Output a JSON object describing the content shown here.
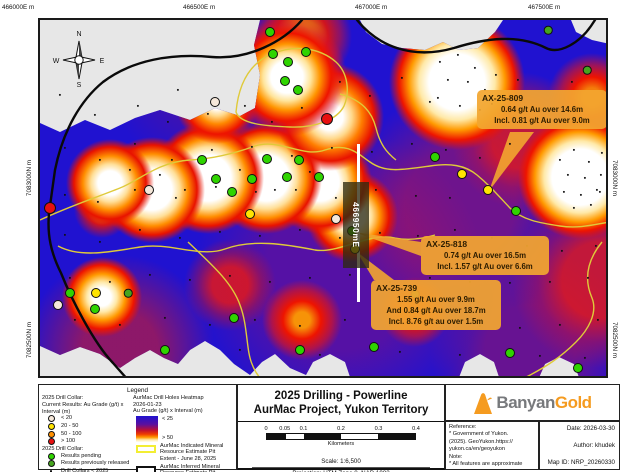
{
  "map": {
    "easting_labels": [
      "466000E m",
      "466500E m",
      "467000E m",
      "467500E m"
    ],
    "northing_labels": [
      "7083000N m",
      "7082500N m"
    ],
    "compass": {
      "north": "N",
      "east": "E",
      "south": "S",
      "west": "W"
    },
    "section_line_label": "466950mE",
    "annotations": [
      {
        "hole_id": "AX-25-809",
        "lines": [
          "0.64 g/t Au over 14.6m",
          "Incl. 0.81 g/t Au over 9.0m"
        ]
      },
      {
        "hole_id": "AX-25-818",
        "lines": [
          "0.74 g/t Au over 16.5m",
          "Incl. 1.57 g/t Au over 6.6m"
        ]
      },
      {
        "hole_id": "AX-25-739",
        "lines": [
          "1.55 g/t Au over 9.9m",
          "And 0.84 g/t Au over 18.7m",
          "Incl. 8.76 g/t au over 1.5m"
        ]
      }
    ],
    "markers": {
      "black": [
        [
          20,
          75
        ],
        [
          55,
          95
        ],
        [
          98,
          86
        ],
        [
          138,
          70
        ],
        [
          128,
          102
        ],
        [
          168,
          94
        ],
        [
          205,
          86
        ],
        [
          232,
          102
        ],
        [
          262,
          88
        ],
        [
          300,
          62
        ],
        [
          330,
          76
        ],
        [
          362,
          58
        ],
        [
          390,
          82
        ],
        [
          452,
          84
        ],
        [
          478,
          60
        ],
        [
          505,
          88
        ],
        [
          532,
          62
        ],
        [
          25,
          128
        ],
        [
          60,
          140
        ],
        [
          95,
          124
        ],
        [
          132,
          140
        ],
        [
          172,
          130
        ],
        [
          212,
          127
        ],
        [
          252,
          136
        ],
        [
          292,
          128
        ],
        [
          332,
          132
        ],
        [
          372,
          124
        ],
        [
          406,
          130
        ],
        [
          440,
          138
        ],
        [
          470,
          124
        ],
        [
          25,
          175
        ],
        [
          58,
          182
        ],
        [
          95,
          170
        ],
        [
          136,
          178
        ],
        [
          176,
          167
        ],
        [
          216,
          172
        ],
        [
          256,
          170
        ],
        [
          296,
          178
        ],
        [
          336,
          170
        ],
        [
          376,
          176
        ],
        [
          410,
          178
        ],
        [
          446,
          172
        ],
        [
          560,
          172
        ],
        [
          25,
          215
        ],
        [
          60,
          222
        ],
        [
          100,
          210
        ],
        [
          140,
          218
        ],
        [
          180,
          212
        ],
        [
          220,
          216
        ],
        [
          260,
          210
        ],
        [
          300,
          218
        ],
        [
          340,
          213
        ],
        [
          378,
          216
        ],
        [
          415,
          210
        ],
        [
          452,
          218
        ],
        [
          487,
          226
        ],
        [
          522,
          231
        ],
        [
          556,
          226
        ],
        [
          30,
          258
        ],
        [
          70,
          262
        ],
        [
          110,
          255
        ],
        [
          150,
          260
        ],
        [
          190,
          256
        ],
        [
          230,
          262
        ],
        [
          270,
          258
        ],
        [
          310,
          255
        ],
        [
          350,
          262
        ],
        [
          390,
          258
        ],
        [
          430,
          262
        ],
        [
          470,
          263
        ],
        [
          510,
          262
        ],
        [
          548,
          258
        ],
        [
          35,
          300
        ],
        [
          80,
          305
        ],
        [
          125,
          298
        ],
        [
          170,
          305
        ],
        [
          215,
          300
        ],
        [
          260,
          306
        ],
        [
          305,
          300
        ],
        [
          350,
          305
        ],
        [
          395,
          302
        ],
        [
          440,
          306
        ],
        [
          480,
          308
        ],
        [
          520,
          305
        ],
        [
          558,
          300
        ],
        [
          200,
          330
        ],
        [
          280,
          335
        ],
        [
          360,
          332
        ],
        [
          420,
          335
        ],
        [
          500,
          336
        ],
        [
          545,
          338
        ],
        [
          520,
          140
        ],
        [
          534,
          130
        ],
        [
          549,
          142
        ],
        [
          562,
          133
        ],
        [
          528,
          155
        ],
        [
          545,
          158
        ],
        [
          561,
          155
        ],
        [
          524,
          172
        ],
        [
          541,
          175
        ],
        [
          557,
          170
        ],
        [
          534,
          188
        ],
        [
          551,
          185
        ],
        [
          400,
          42
        ],
        [
          418,
          35
        ],
        [
          435,
          48
        ],
        [
          408,
          60
        ],
        [
          428,
          62
        ],
        [
          445,
          70
        ],
        [
          398,
          78
        ],
        [
          420,
          86
        ],
        [
          440,
          90
        ],
        [
          456,
          55
        ],
        [
          120,
          155
        ],
        [
          145,
          170
        ],
        [
          200,
          150
        ],
        [
          235,
          170
        ],
        [
          270,
          152
        ],
        [
          90,
          150
        ]
      ],
      "pending": [
        [
          230,
          12
        ],
        [
          233,
          34
        ],
        [
          248,
          42
        ],
        [
          245,
          61
        ],
        [
          258,
          70
        ],
        [
          266,
          32
        ],
        [
          162,
          140
        ],
        [
          176,
          159
        ],
        [
          212,
          159
        ],
        [
          227,
          139
        ],
        [
          247,
          157
        ],
        [
          259,
          140
        ],
        [
          279,
          157
        ],
        [
          192,
          172
        ],
        [
          312,
          211
        ],
        [
          395,
          137
        ],
        [
          476,
          191
        ],
        [
          30,
          273
        ],
        [
          55,
          289
        ],
        [
          194,
          298
        ],
        [
          125,
          330
        ],
        [
          260,
          330
        ],
        [
          334,
          327
        ],
        [
          470,
          333
        ],
        [
          538,
          348
        ]
      ],
      "released": [
        [
          508,
          10
        ],
        [
          547,
          50
        ],
        [
          375,
          274
        ],
        [
          88,
          273
        ]
      ],
      "yellow": [
        [
          422,
          154
        ],
        [
          448,
          170
        ],
        [
          210,
          194
        ],
        [
          56,
          273
        ],
        [
          315,
          229
        ]
      ],
      "low": [
        [
          175,
          82
        ],
        [
          109,
          170
        ],
        [
          296,
          199
        ],
        [
          18,
          285
        ]
      ],
      "red": [
        [
          287,
          99
        ],
        [
          10,
          188
        ]
      ]
    }
  },
  "legend": {
    "title": "Legend",
    "collar_2025_header": "2025 Drill Collar:",
    "current_results_header": "Current Results: Au Grade (g/t) x Interval (m)",
    "grade_classes": [
      {
        "label": "< 20",
        "color": "#f6e8da"
      },
      {
        "label": "20 - 50",
        "color": "#ffe400"
      },
      {
        "label": "50 - 100",
        "color": "#ff9000"
      },
      {
        "label": "> 100",
        "color": "#e81010"
      }
    ],
    "collar_status_header": "2025 Drill Collar:",
    "status_classes": [
      {
        "label": "Results pending",
        "color": "#2fd400"
      },
      {
        "label": "Results previously released",
        "color": "#46a51e"
      },
      {
        "label": "Drill Collars < 2025",
        "color": "#111111"
      }
    ],
    "heatmap_title": "AurMac Drill Holes Heatmap",
    "heatmap_date": "2026-01-23",
    "heatmap_subtitle": "Au Grade (g/t) x Interval (m)",
    "heatmap_min_label": "< 25",
    "heatmap_max_label": "> 50",
    "indicated_label": "AurMac Indicated Mineral Resource Estimate Pit Extent - June 28, 2025",
    "inferred_label": "AurMac Inferred Mineral Resource Estimate Pit Extent - June 28, 2025",
    "boundary_label": "AurMac Project Boundary"
  },
  "title_block": {
    "title_line1": "2025 Drilling - Powerline",
    "title_line2": "AurMac Project, Yukon Territory",
    "scale_bar": {
      "ticks": [
        "0",
        "0.05",
        "0.1",
        "0.2",
        "0.3",
        "0.4"
      ],
      "units": "Kilometers"
    },
    "scale_text": "Scale: 1:6,500",
    "projection_text": "Projection: UTM Zone 8, NAD 1983"
  },
  "branding": {
    "name_part1": "Banyan",
    "name_part2": "Gold",
    "accent_color": "#f59b20",
    "gray_color": "#77797c"
  },
  "info": {
    "reference_header": "Reference:",
    "reference_lines": [
      "* Government of Yukon.",
      "(2025).  GeoYukon.https://",
      "yukon.ca/en/geoyukon"
    ],
    "note_header": "Note:",
    "note_line": "* All features are approximate",
    "date": "Date: 2026-03-30",
    "author": "Author: khudek",
    "map_id": "Map ID: NRP_20260330"
  }
}
